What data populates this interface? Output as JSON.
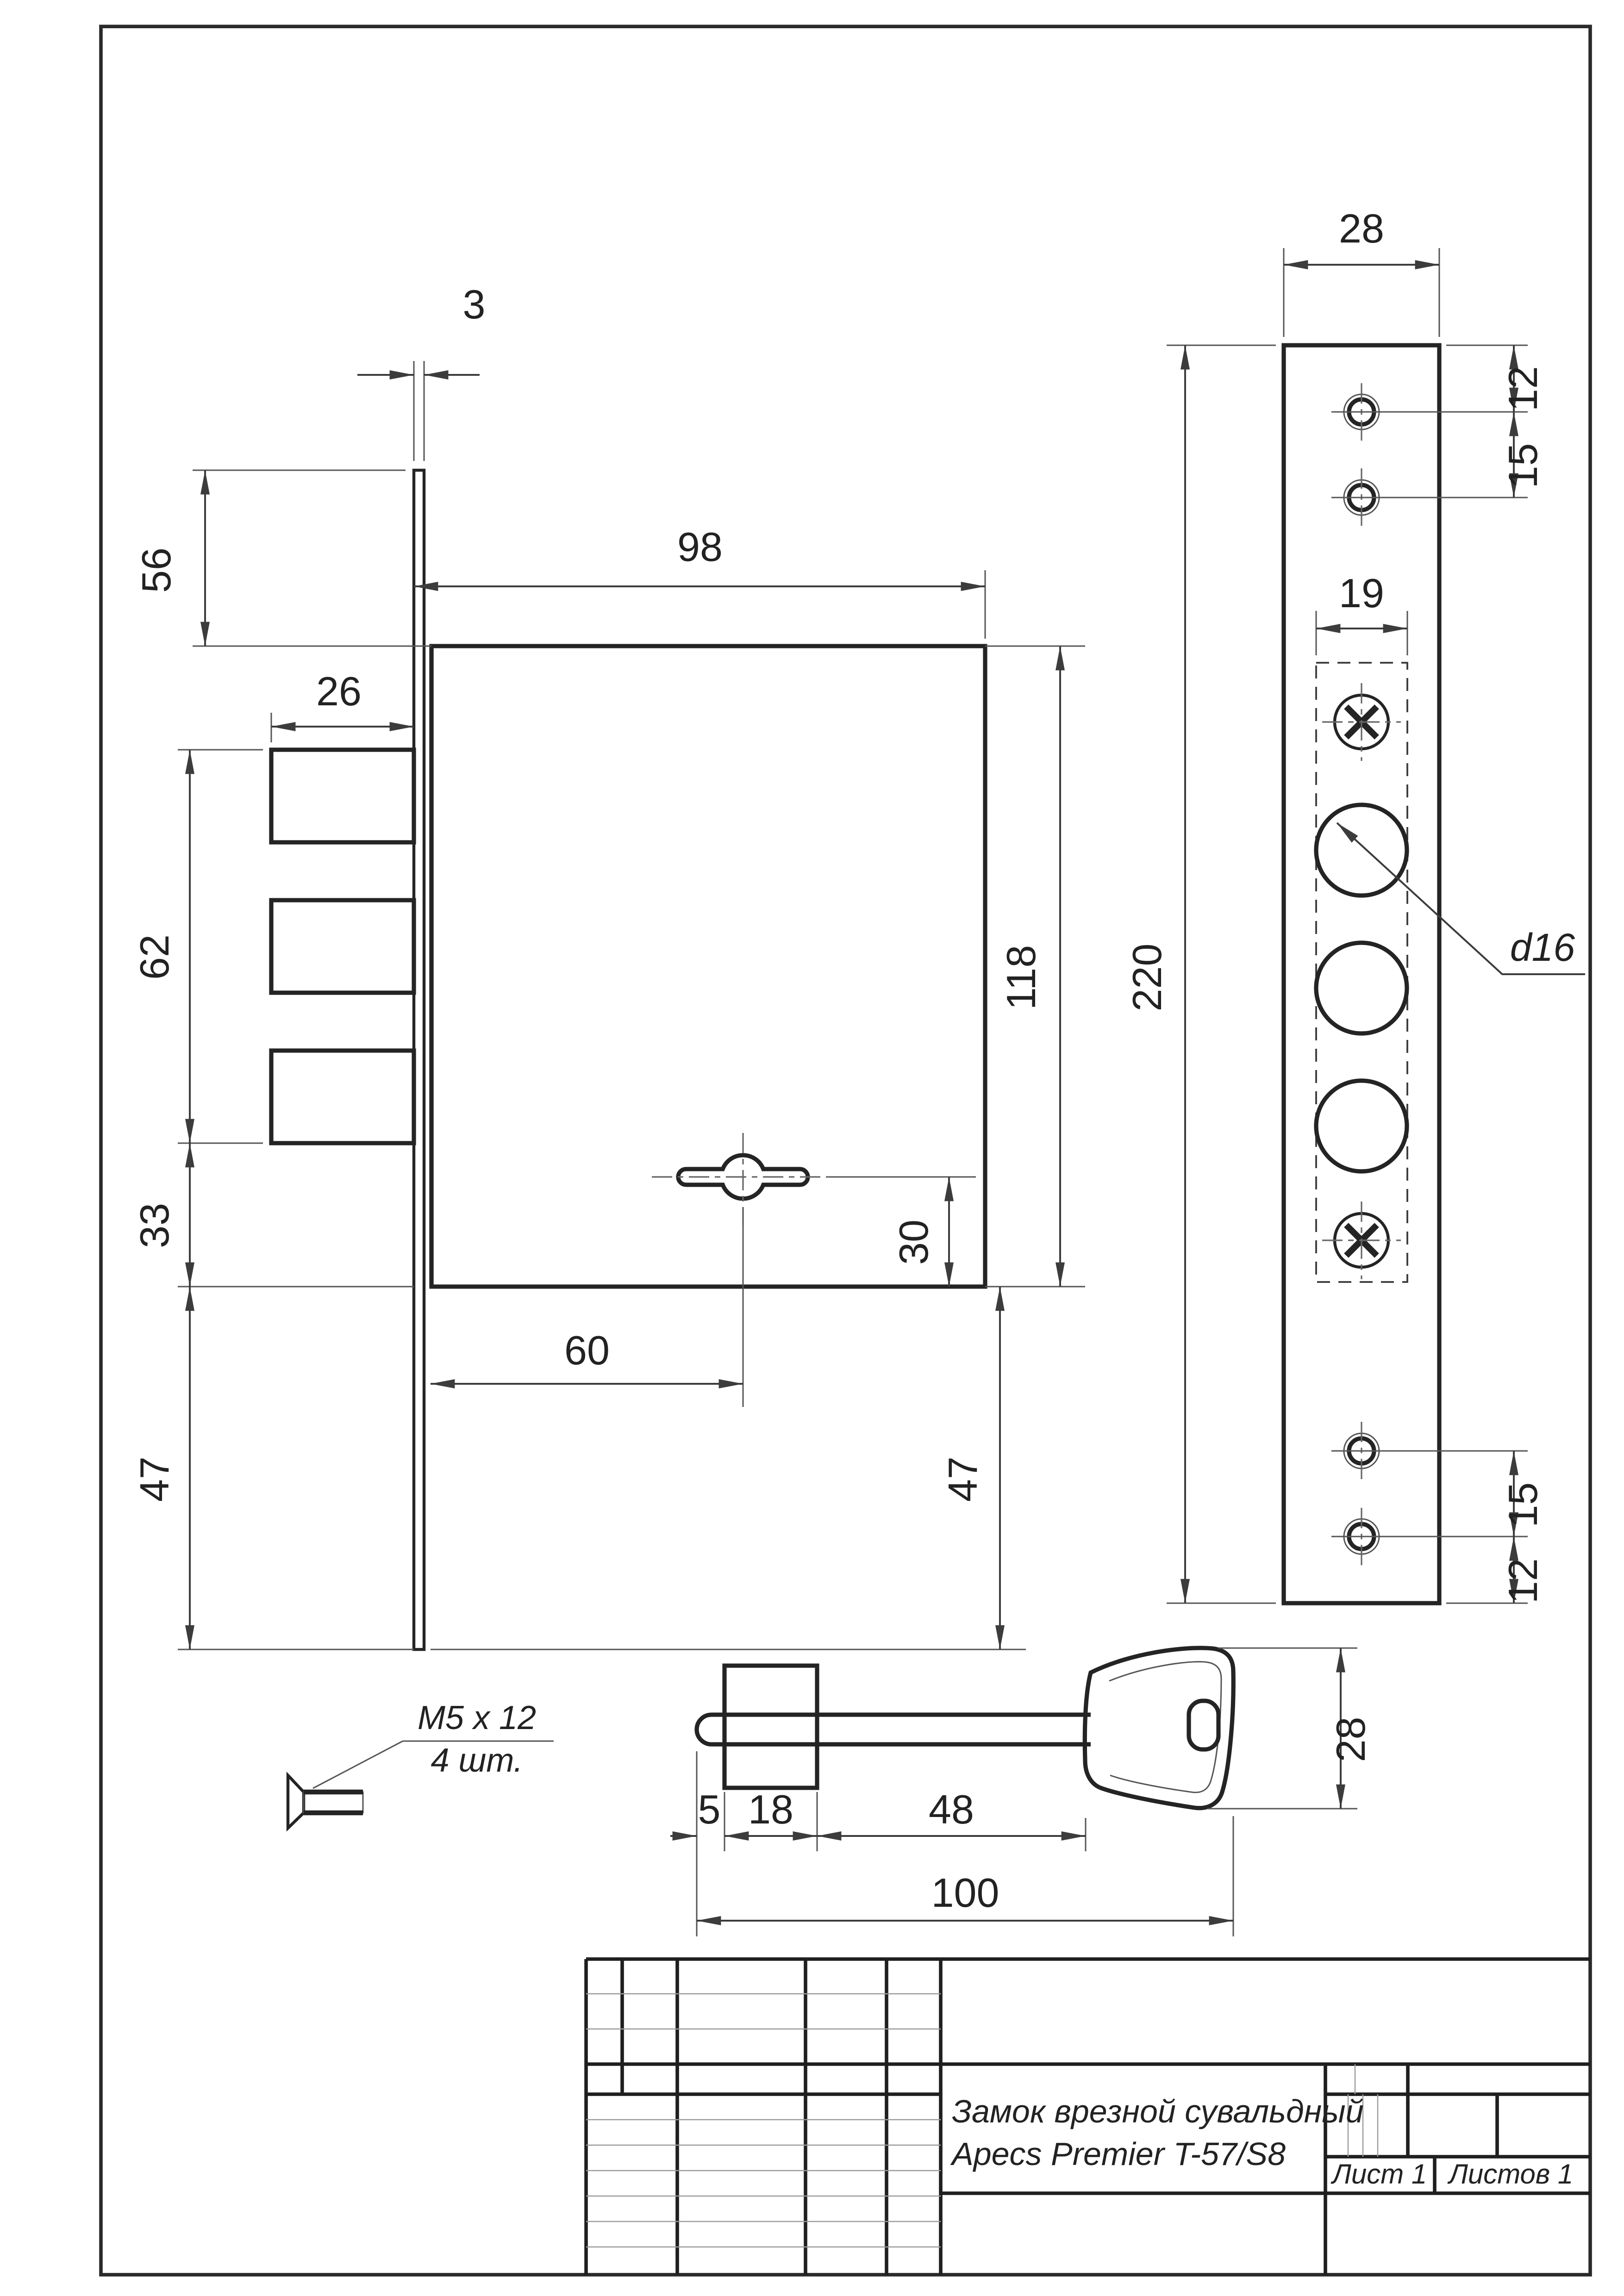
{
  "drawing": {
    "bg_color": "#ffffff",
    "line_color": "#242424",
    "thin_line_color": "#555555"
  },
  "side_view": {
    "dim_plate_thickness": "3",
    "dim_top_offset": "56",
    "dim_body_width": "98",
    "dim_bolt_throw": "26",
    "dim_bolt_span": "62",
    "dim_bolt_to_body_bottom": "33",
    "dim_body_bottom_to_plate_left": "47",
    "dim_keyhole_offset": "60",
    "dim_keyhole_to_body_bottom": "30",
    "dim_body_height": "118",
    "dim_body_bottom_to_plate_right": "47"
  },
  "face_view": {
    "dim_plate_width": "28",
    "dim_plate_height": "220",
    "dim_top_hole_offset": "12",
    "dim_top_hole_pitch": "15",
    "dim_cutout_width": "19",
    "dim_hole_diameter": "d16",
    "dim_bottom_hole_pitch": "15",
    "dim_bottom_hole_offset": "12"
  },
  "key_view": {
    "dim_tip": "5",
    "dim_bit": "18",
    "dim_shaft": "48",
    "dim_total_length": "100",
    "dim_head_height": "28"
  },
  "screw_detail": {
    "label_spec": "M5 x 12",
    "label_qty": "4 шт."
  },
  "title_block": {
    "title_line1": "Замок врезной сувальдный",
    "title_line2": "Apecs Premier T-57/S8",
    "sheet_label": "Лист 1",
    "sheets_label": "Листов 1"
  }
}
